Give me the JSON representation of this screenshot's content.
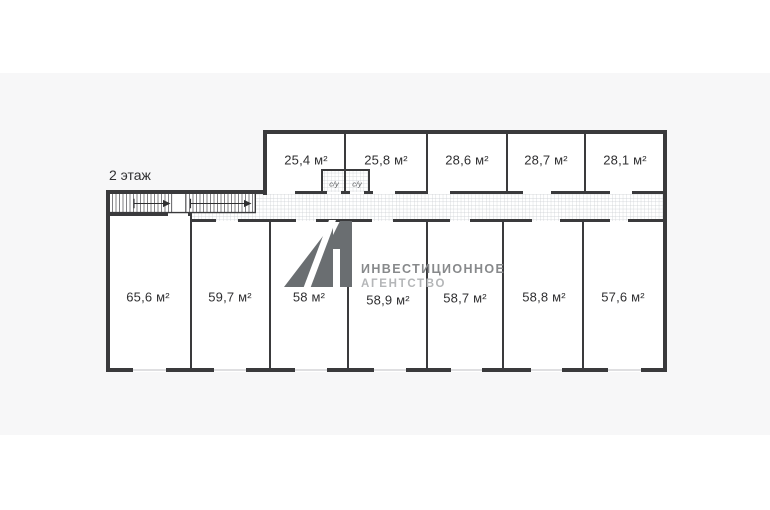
{
  "page": {
    "background": "#ffffff",
    "panel_color": "#f7f7f8"
  },
  "plan": {
    "floor_label": "2 этаж",
    "top_rooms": [
      {
        "area": "25,4 м²"
      },
      {
        "area": "25,8 м²"
      },
      {
        "area": "28,6 м²"
      },
      {
        "area": "28,7 м²"
      },
      {
        "area": "28,1 м²"
      }
    ],
    "bottom_rooms": [
      {
        "area": "65,6 м²"
      },
      {
        "area": "59,7 м²"
      },
      {
        "area": "58 м²"
      },
      {
        "area": "58,9 м²"
      },
      {
        "area": "58,7 м²"
      },
      {
        "area": "58,8 м²"
      },
      {
        "area": "57,6 м²"
      }
    ],
    "bathrooms": [
      {
        "label": "с/у"
      },
      {
        "label": "с/у"
      }
    ],
    "colors": {
      "wall": "#3a3a3c",
      "hatch": "#c6cace",
      "window": "#dfdfe1",
      "room_fill": "#ffffff",
      "label_text": "#2f2f31"
    }
  },
  "watermark": {
    "logo": "А1",
    "line1": "ИНВЕСТИЦИОННОЕ",
    "line2": "АГЕНТСТВО",
    "logo_color": "#6a6e71",
    "line1_color": "#87898b",
    "line2_color": "#b4b6b8"
  }
}
